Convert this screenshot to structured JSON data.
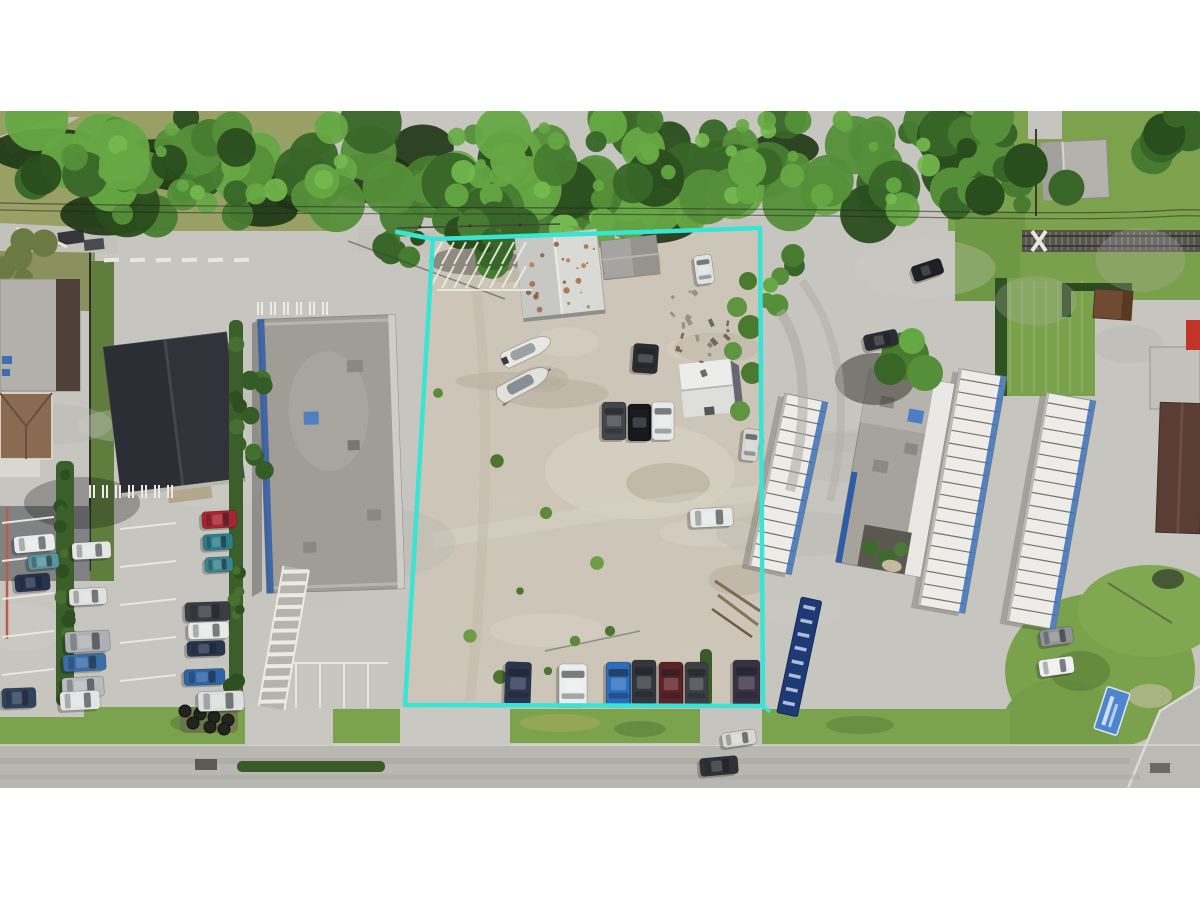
{
  "meta": {
    "domain": "Natural-Image",
    "description": "Aerial drone photograph of a commercial dirt lot outlined with a cyan property boundary, flanked by retail buildings and parking lots, a car-wash with canopies on the right, a dense tree line, power lines and a railroad crossing along the top, and a concrete street with grass verges along the bottom. White letterbox bands above and below the photo.",
    "letterbox_color": "#ffffff"
  },
  "photo": {
    "area": {
      "x": 0,
      "y": 111,
      "width": 1200,
      "height": 677
    },
    "boundary": {
      "color": "#38e4d3",
      "stroke_width": 4.5,
      "corners_px": [
        [
          433,
          239
        ],
        [
          760,
          228
        ],
        [
          763,
          706
        ],
        [
          405,
          705
        ]
      ],
      "overshoot_top_left_px": [
        397,
        232
      ]
    },
    "scene": {
      "subject_lot": {
        "surface": "bare dirt and gravel",
        "buildings": [
          {
            "name": "main-white-metal-roof-building",
            "roof_color": "#d9d9d6"
          },
          {
            "name": "secondary-gray-roof-building",
            "roof_color": "#a5a4a0"
          },
          {
            "name": "white-shed",
            "roof_color": "#ececea"
          }
        ],
        "vehicles": "two boats on trailers, scattered cars and a white van",
        "parked_cars_bottom_row": 7
      },
      "left_side": {
        "buildings": [
          {
            "name": "gray-roof-building-brown-edge",
            "roof_color": "#b3b0ab"
          },
          {
            "name": "tan-hip-roof-building",
            "roof_color": "#8a6a50"
          },
          {
            "name": "dark-gable-roof-building",
            "roof_color": "#31333a"
          },
          {
            "name": "large-gray-flat-roof-building",
            "roof_color": "#a09d97",
            "trim_color": "#2d59a2"
          }
        ],
        "features": [
          "angled parking rows with white stripes",
          "green hedgerows",
          "diagonal striped crosswalk",
          "red curb line"
        ]
      },
      "right_side": {
        "buildings": [
          {
            "name": "car-wash-canopies",
            "count": 3,
            "roof_color": "#edece9",
            "trim_color": "#3a70b4"
          },
          {
            "name": "car-wash-office-building",
            "roof_color": "#a6a39d"
          },
          {
            "name": "far-right-maroon-roof-building",
            "roof_color": "#5a3e35"
          },
          {
            "name": "brown-shed",
            "roof_color": "#6f4b34"
          }
        ],
        "features": [
          "grass strips",
          "blue ground sign on grass mound (text illegible)",
          "dark blue vertical banner (text illegible)"
        ]
      },
      "top": {
        "features": [
          "dense tree canopy",
          "power lines",
          "railroad track with crossing",
          "gray gable-roof house",
          "olive grass field top-left"
        ]
      },
      "bottom": {
        "features": [
          "concrete street",
          "grass verge with hedge median",
          "driveway aprons",
          "pile of dark tires"
        ]
      }
    }
  }
}
